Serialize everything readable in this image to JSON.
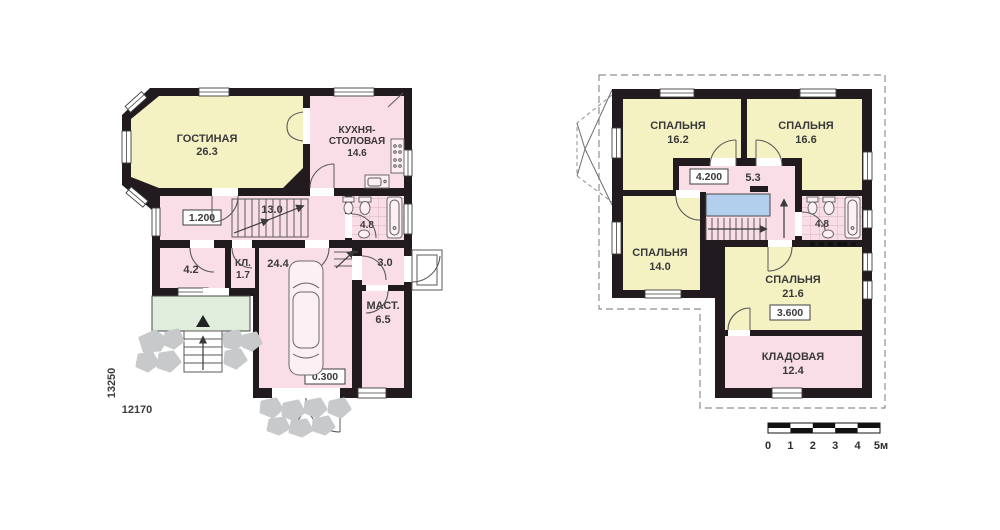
{
  "floor1": {
    "living": {
      "name": "ГОСТИНАЯ",
      "area": "26.3"
    },
    "kitchen": {
      "name_line1": "КУХНЯ-",
      "name_line2": "СТОЛОВАЯ",
      "area": "14.6"
    },
    "hall": {
      "area": "13.0",
      "level": "1.200"
    },
    "bath": {
      "area": "4.8"
    },
    "room": {
      "area": "4.2"
    },
    "closet": {
      "name": "КЛ.",
      "area": "1.7"
    },
    "garage": {
      "area": "24.4",
      "level": "0.300"
    },
    "vestibule": {
      "area": "3.0"
    },
    "workshop": {
      "name": "МАСТ.",
      "area": "6.5"
    },
    "dim_vertical": "13250",
    "dim_horizontal": "12170"
  },
  "floor2": {
    "bedroom1": {
      "name": "СПАЛЬНЯ",
      "area": "16.2"
    },
    "bedroom2": {
      "name": "СПАЛЬНЯ",
      "area": "16.6"
    },
    "bedroom3": {
      "name": "СПАЛЬНЯ",
      "area": "14.0"
    },
    "bedroom4": {
      "name": "СПАЛЬНЯ",
      "area": "21.6",
      "level": "3.600"
    },
    "hall": {
      "area": "5.3",
      "level": "4.200"
    },
    "bath": {
      "area": "4.8"
    },
    "storage": {
      "name": "КЛАДОВАЯ",
      "area": "12.4"
    }
  },
  "scale_bar": {
    "labels": [
      "0",
      "1",
      "2",
      "3",
      "4",
      "5м"
    ]
  },
  "colors": {
    "wall": "#211a1e",
    "room_yellow": "#f4f1c3",
    "room_pink": "#f9dde7",
    "porch_green": "#e0ecdc",
    "stair_void_blue": "#b2cfee",
    "stone_gray": "#c7c9ca",
    "label_text": "#3a3a3a"
  }
}
